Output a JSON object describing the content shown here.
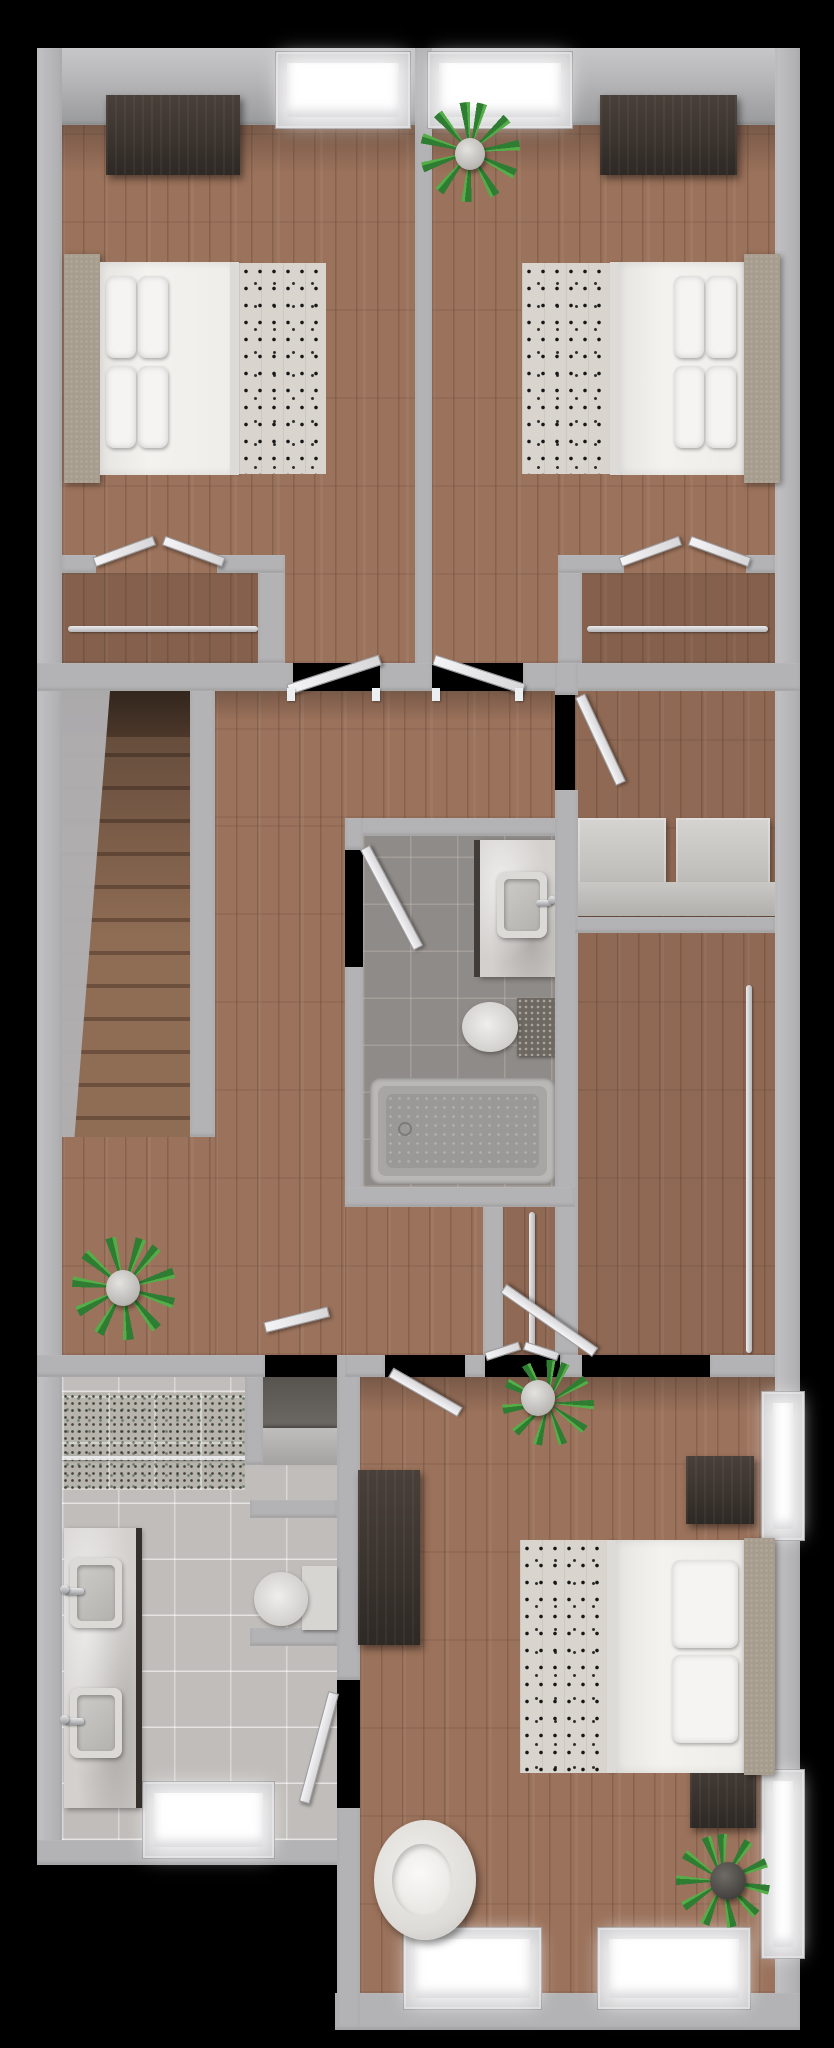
{
  "scene": {
    "description": "3D top-down architectural floor plan render of an apartment upper floor on a black background",
    "view": "top-down dollhouse render",
    "background_color": "#000000"
  },
  "palette": {
    "background": "#000000",
    "wall": "#b3b2b4",
    "wall_light": "#c7c6c8",
    "wood_floor": "#9b725b",
    "stair_wood": "#6c4f3c",
    "gray_tile": "#8f8b88",
    "light_tile": "#c6c3c0",
    "mosaic_tile": "#b7b4ab",
    "espresso_furniture": "#352e29",
    "bed_linen": "#f3f2ef",
    "dotted_throw": "#d9d5ce",
    "headboard": "#a79d8e",
    "plant_green": "#2e7d32",
    "window_glow": "#ffffff",
    "chrome": "#97999c"
  },
  "rooms": [
    {
      "id": "bedroom-top-left",
      "label": "Bedroom 1 (top left)",
      "floor_material": "wood",
      "furniture": [
        "double bed with white duvet, dotted throw and 4 pillows",
        "upholstered headboard on left wall",
        "dark dresser on top wall",
        "closet with hanging rod and open bifold doors",
        "window in top wall",
        "open entry door"
      ]
    },
    {
      "id": "bedroom-top-right",
      "label": "Bedroom 2 (top right)",
      "floor_material": "wood",
      "furniture": [
        "double bed with white duvet, dotted throw and 4 pillows",
        "upholstered headboard on right wall",
        "dark dresser on top wall",
        "potted plant",
        "closet with hanging rod and open bifold doors",
        "window in top wall",
        "open entry door"
      ]
    },
    {
      "id": "hallway",
      "label": "Hallway landing",
      "floor_material": "wood",
      "furniture": [
        "staircase with railing wall",
        "potted plant"
      ]
    },
    {
      "id": "hall-bathroom",
      "label": "Hall bathroom (center)",
      "floor_material": "gray tile",
      "furniture": [
        "vanity counter with vessel sink and faucet",
        "toilet with stone tank",
        "bathtub",
        "open door"
      ]
    },
    {
      "id": "laundry-closet",
      "label": "Laundry closet",
      "floor_material": "wood",
      "furniture": [
        "washer",
        "dryer",
        "front panel",
        "open door"
      ]
    },
    {
      "id": "walk-in-closet",
      "label": "Walk-in closet",
      "floor_material": "wood",
      "furniture": [
        "vertical hanging rod",
        "open door"
      ]
    },
    {
      "id": "reach-in-closet",
      "label": "Reach-in closet",
      "floor_material": "wood",
      "furniture": [
        "hanging rod",
        "open bifold doors"
      ]
    },
    {
      "id": "linen-closet",
      "label": "Linen closet niche",
      "floor_material": "none",
      "furniture": [
        "gray shelf",
        "open door"
      ]
    },
    {
      "id": "bedroom-bottom",
      "label": "Primary bedroom (bottom)",
      "floor_material": "wood",
      "furniture": [
        "double bed with white duvet, dotted throw and 2 pillows",
        "two dark nightstands",
        "long dark dresser on left wall",
        "white armchair",
        "two potted plants",
        "two windows in right wall",
        "two windows in bottom wall",
        "open entry door"
      ]
    },
    {
      "id": "ensuite-bathroom",
      "label": "Ensuite bathroom (bottom left)",
      "floor_material": "light tile",
      "furniture": [
        "mosaic tile shower with glass panel",
        "double marble vanity with two vessel sinks and faucets",
        "toilet",
        "window in bottom wall",
        "open door to primary bedroom"
      ]
    }
  ],
  "counts": {
    "bedrooms": 3,
    "bathrooms": 2,
    "beds": 3,
    "closets": 6,
    "windows": 7,
    "open_doors": 9,
    "plants": 4,
    "staircases": 1,
    "sinks": 3,
    "toilets": 2,
    "bathtubs": 1,
    "showers": 1
  }
}
